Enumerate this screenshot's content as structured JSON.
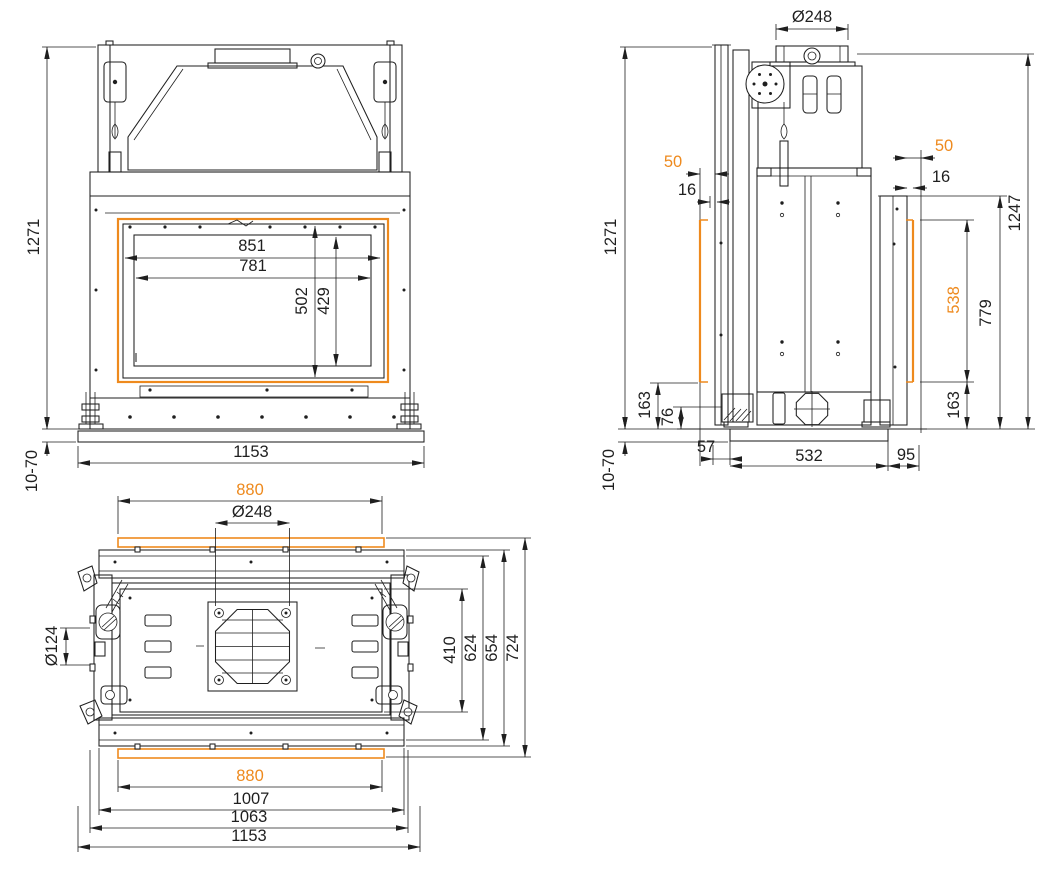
{
  "colors": {
    "line": "#1f1f1f",
    "accent": "#ee8a1e",
    "background": "#ffffff"
  },
  "views": {
    "front": {
      "dims": {
        "overall_height": "1271",
        "floor_adjustment": "10-70",
        "frame_width": "851",
        "glass_width": "781",
        "frame_height": "502",
        "glass_height": "429",
        "overall_width": "1153"
      }
    },
    "side": {
      "dims": {
        "flue_diameter": "Ø248",
        "front_offset_50": "50",
        "front_offset_16": "16",
        "overall_height": "1271",
        "rear_offset_50": "50",
        "rear_offset_16": "16",
        "rear_height": "1247",
        "trim_height": "538",
        "rear_panel_height": "779",
        "front_clearance": "163",
        "foot_clearance": "76",
        "rear_clearance": "163",
        "front_depth": "57",
        "base_depth": "532",
        "rear_depth": "95",
        "floor_adjustment": "10-70"
      }
    },
    "top": {
      "dims": {
        "trim_width_front": "880",
        "flue_diameter": "Ø248",
        "side_outlet_diameter": "Ø124",
        "inner_depth": "410",
        "body_depth": "624",
        "flange_depth": "654",
        "overall_depth": "724",
        "trim_width_rear": "880",
        "frame_width": "1007",
        "body_width": "1063",
        "overall_width": "1153"
      }
    }
  }
}
